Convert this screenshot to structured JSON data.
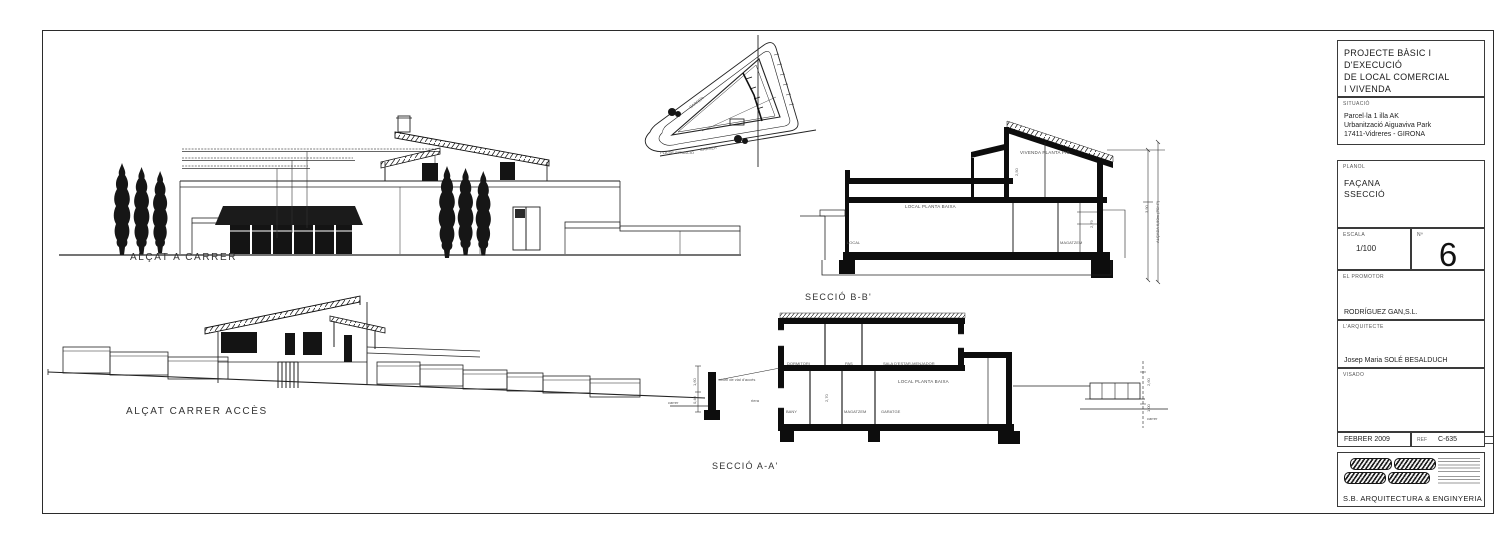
{
  "tb": {
    "project_lines": [
      "PROJECTE BÀSIC I",
      "D'EXECUCIÓ",
      "DE LOCAL COMERCIAL",
      "I VIVENDA"
    ],
    "situacio_label": "SITUACIÓ",
    "situacio_lines": [
      "Parcel·la 1 illa AK",
      "Urbanització Aiguaviva Park",
      "17411-Vidreres -  GIRONA"
    ],
    "planol_label": "PLANOL",
    "planol_lines": [
      "FAÇANA",
      "SSECCIÓ"
    ],
    "escala_label": "ESCALA",
    "escala_value": "1/100",
    "num_label": "Nº",
    "num_value": "6",
    "promotor_label": "EL PROMOTOR",
    "promotor_value": "RODRÍGUEZ GAN,S.L.",
    "arquitecte_label": "L'ARQUITECTE",
    "arquitecte_value": "Josep Maria SOLÉ BESALDUCH",
    "visado_label": "VISADO",
    "date_value": "FEBRER 2009",
    "ref_label": "REF",
    "ref_value": "C-635",
    "firm": "S.B. ARQUITECTURA & ENGINYERIA"
  },
  "el1": {
    "label": "ALÇAT A CARRER"
  },
  "el2": {
    "label": "ALÇAT CARRER ACCÈS"
  },
  "sb": {
    "label": "SECCIÓ B-B'",
    "vivenda": "VIVENDA PLANTA PIS",
    "local": "LOCAL PLANTA BAIXA",
    "local_small": "LOCAL",
    "magatzem": "MAGATZEM",
    "dim_250": "2,50",
    "dim_279": "2,79",
    "dim_390": "3,90",
    "dim_650": "ALÇADA 6,50m (PB+P)"
  },
  "sa": {
    "label": "SECCIÓ A-A'",
    "dormitori": "DORMITORI",
    "pas": "PAS",
    "sala": "SALA D'ESTAR-MENJADOR",
    "local": "LOCAL PLANTA BAIXA",
    "bany": "BANY",
    "magatzem": "MAGATZEM",
    "garatge": "GARATGE",
    "nivell": "nivell de vial d'accés",
    "riera": "riera",
    "carrer": "carrer",
    "dim_160": "1,60",
    "dim_040": "0,40",
    "dim_270": "2,70",
    "dim_260": "2,60",
    "dim_100": "1,00"
  },
  "sp": {
    "label": "PLA DE SITUACIÓ",
    "street": "CARRER"
  }
}
